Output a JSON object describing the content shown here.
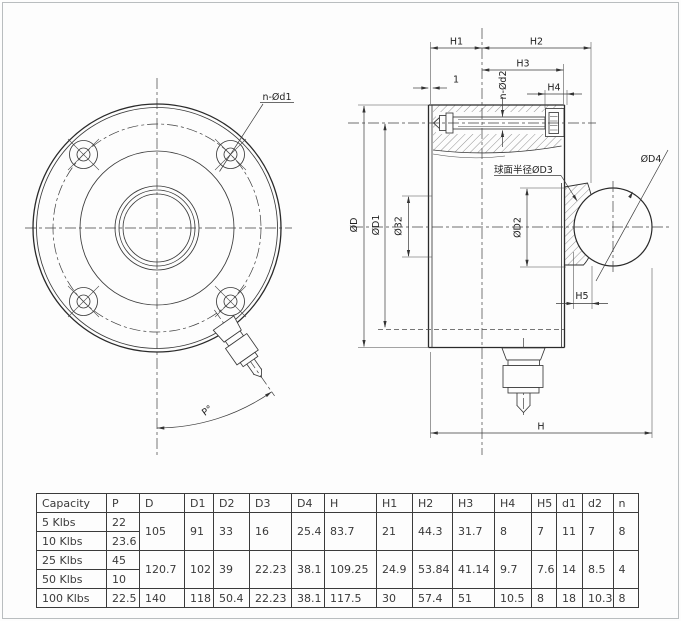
{
  "labels": {
    "h1": "H1",
    "h2": "H2",
    "h3": "H3",
    "h4": "H4",
    "h5": "H5",
    "h": "H",
    "plate_thickness": "1",
    "n_od1": "n-Ød1",
    "n_od2": "n-Ød2",
    "od": "ØD",
    "od1": "ØD1",
    "o32": "Ø32",
    "od2": "ØD2",
    "sphere_od3": "球面半径ØD3",
    "od4": "ØD4",
    "angle_p": "P°"
  },
  "table": {
    "columns": [
      "Capacity",
      "P",
      "D",
      "D1",
      "D2",
      "D3",
      "D4",
      "H",
      "H1",
      "H2",
      "H3",
      "H4",
      "H5",
      "d1",
      "d2",
      "n"
    ],
    "rows": [
      {
        "capacity": "5 Klbs",
        "p": "22"
      },
      {
        "capacity": "10 Klbs",
        "p": "23.6"
      },
      {
        "capacity": "25 Klbs",
        "p": "45"
      },
      {
        "capacity": "50 Klbs",
        "p": "10"
      },
      {
        "capacity": "100 Klbs",
        "p": "22.5"
      }
    ],
    "groups": [
      {
        "D": "105",
        "D1": "91",
        "D2": "33",
        "D3": "16",
        "D4": "25.4",
        "H": "83.7",
        "H1": "21",
        "H2": "44.3",
        "H3": "31.7",
        "H4": "8",
        "H5": "7",
        "d1": "11",
        "d2": "7",
        "n": "8"
      },
      {
        "D": "120.7",
        "D1": "102",
        "D2": "39",
        "D3": "22.23",
        "D4": "38.1",
        "H": "109.25",
        "H1": "24.9",
        "H2": "53.84",
        "H3": "41.14",
        "H4": "9.7",
        "H5": "7.6",
        "d1": "14",
        "d2": "8.5",
        "n": "4"
      },
      {
        "D": "140",
        "D1": "118",
        "D2": "50.4",
        "D3": "22.23",
        "D4": "38.1",
        "H": "117.5",
        "H1": "30",
        "H2": "57.4",
        "H3": "51",
        "H4": "10.5",
        "H5": "8",
        "d1": "18",
        "d2": "10.3",
        "n": "8"
      }
    ]
  }
}
